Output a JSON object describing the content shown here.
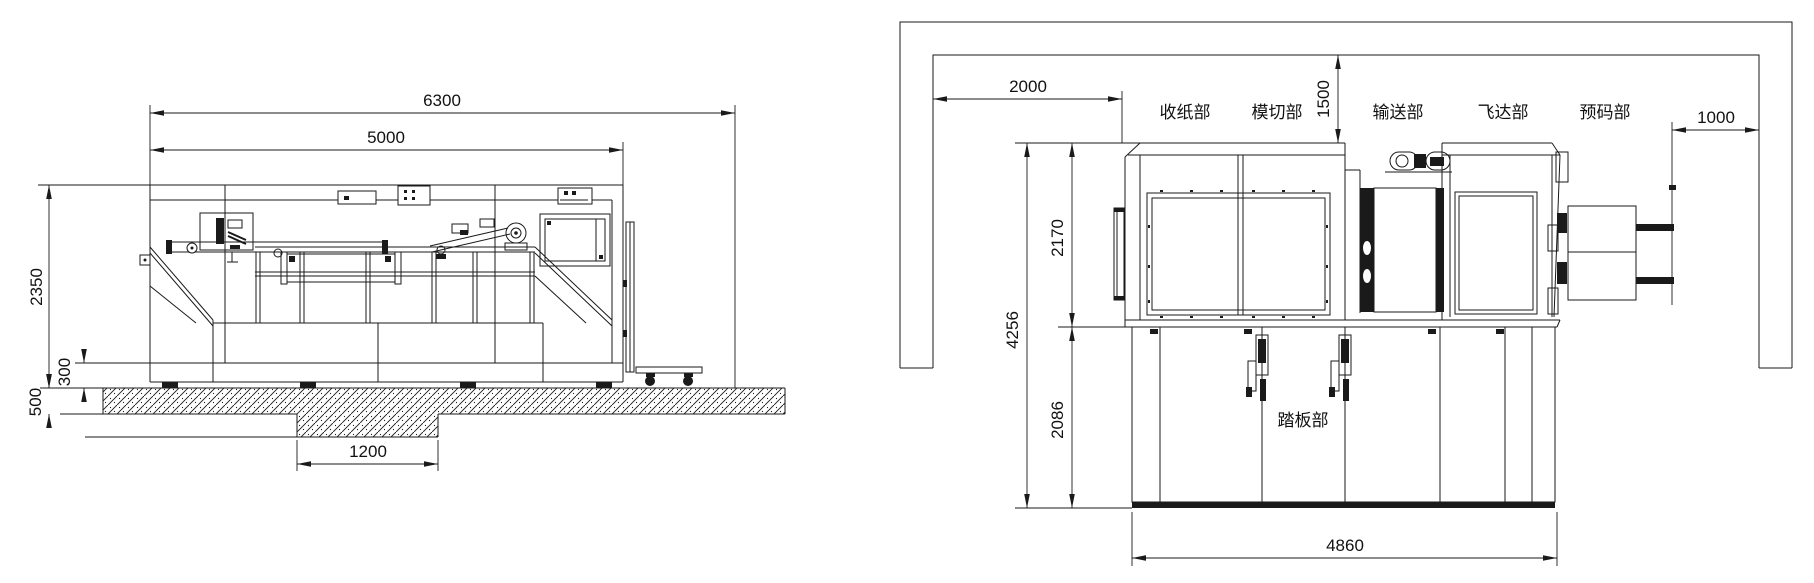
{
  "drawing": {
    "type": "technical-installation-drawing",
    "left_view": {
      "total_width": "6300",
      "body_width": "5000",
      "machine_height": "2350",
      "base_height": "300",
      "foundation_depth": "500",
      "pit_width": "1200"
    },
    "right_view": {
      "left_clearance": "2000",
      "top_clearance": "1500",
      "right_clearance": "1000",
      "upper_section_height": "2170",
      "total_height": "4256",
      "lower_section_height": "2086",
      "base_width": "4860",
      "sections": [
        {
          "label": "收纸部"
        },
        {
          "label": "模切部"
        },
        {
          "label": "输送部"
        },
        {
          "label": "飞达部"
        },
        {
          "label": "预码部"
        }
      ],
      "pedal_section_label": "踏板部"
    },
    "colors": {
      "line": "#1a1a1a",
      "background": "#ffffff"
    }
  }
}
